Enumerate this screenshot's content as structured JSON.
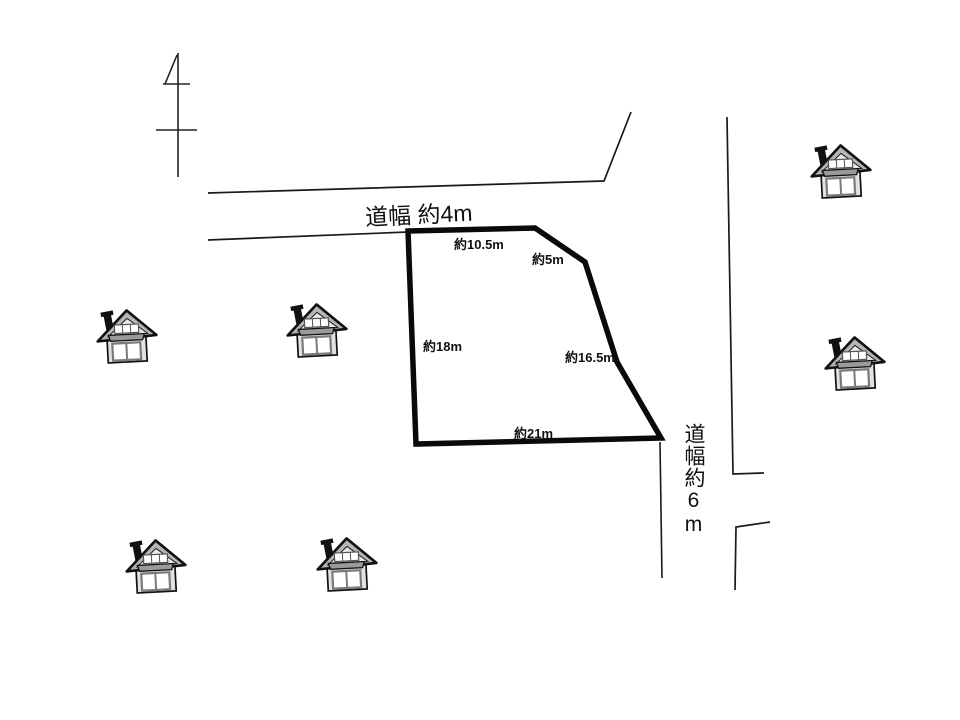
{
  "roads": {
    "top": {
      "label": "道幅 約4m"
    },
    "right": {
      "label": "道幅約6m"
    }
  },
  "plot": {
    "dimensions": {
      "top": "約10.5m",
      "top_right": "約5m",
      "left": "約18m",
      "right": "約16.5m",
      "bottom": "約21m"
    }
  },
  "icons": {
    "house": "house-icon",
    "utility_pole": "utility-pole-icon"
  },
  "colors": {
    "background": "#ffffff",
    "road_line": "#1a1a1a",
    "plot_outline": "#0a0a0a",
    "house_outline": "#111111",
    "house_roof": "#b5b5b5",
    "house_wall": "#e2e2e2",
    "house_awning": "#9a9a9a",
    "chimney": "#111111"
  }
}
